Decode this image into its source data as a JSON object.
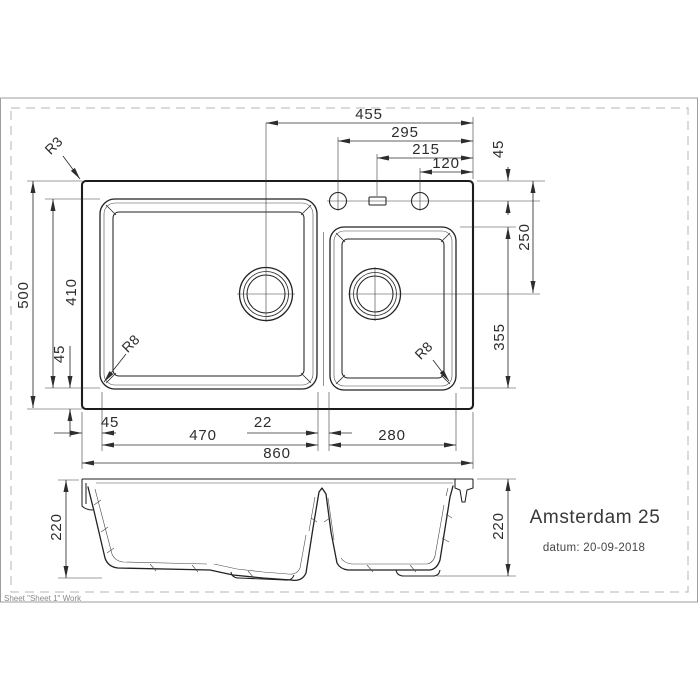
{
  "drawing": {
    "product": "Amsterdam 25",
    "date_label": "datum: 20-09-2018",
    "sheet_note": "Sheet \"Sheet 1\" Work"
  },
  "dims": {
    "d455": "455",
    "d295": "295",
    "d215": "215",
    "d120": "120",
    "d45_top_right": "45",
    "d250": "250",
    "d355": "355",
    "d500": "500",
    "d410": "410",
    "d45_left": "45",
    "d45_bottom": "45",
    "d470": "470",
    "d22": "22",
    "d280": "280",
    "d860": "860",
    "d220_left": "220",
    "d220_right": "220",
    "r3": "R3",
    "r8_main": "R8",
    "r8_small": "R8"
  },
  "colors": {
    "outline": "#1c1c1c",
    "dimension": "#2d2d2d",
    "frame": "#9e9e9e",
    "dashed_border": "#b5b5b5",
    "text": "#383838"
  }
}
